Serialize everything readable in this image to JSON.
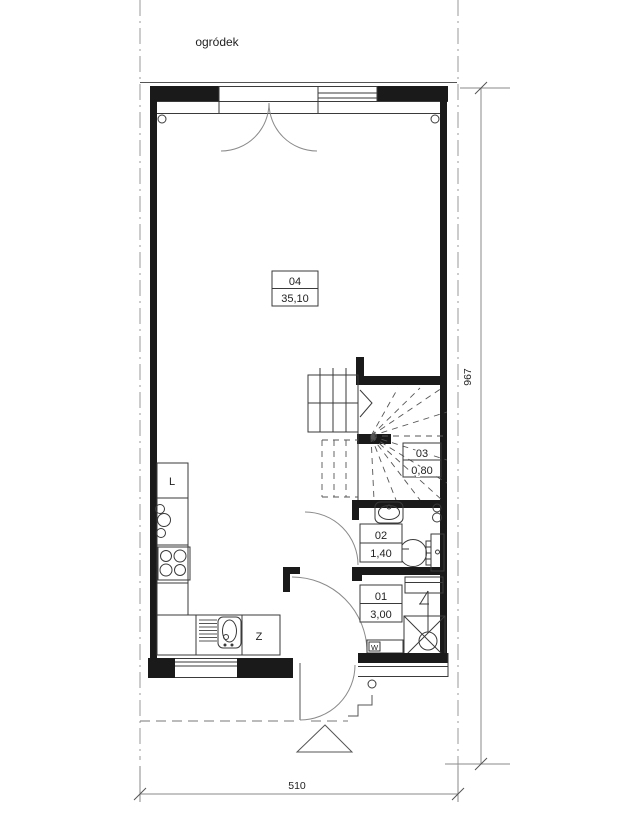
{
  "plan": {
    "garden_label": "ogródek",
    "rooms": [
      {
        "id": "04",
        "area": "35,10"
      },
      {
        "id": "03",
        "area": "0,80"
      },
      {
        "id": "02",
        "area": "1,40"
      },
      {
        "id": "01",
        "area": "3,00"
      }
    ],
    "fixtures": {
      "fridge_label": "L",
      "sink_label": "Z",
      "meter_label": "W"
    },
    "dimensions": {
      "vertical": "967",
      "horizontal": "510"
    },
    "colors": {
      "wall": "#1a1a1a",
      "line": "#3a3a3a",
      "door_arc": "#8a8a8a",
      "background": "#ffffff"
    }
  }
}
